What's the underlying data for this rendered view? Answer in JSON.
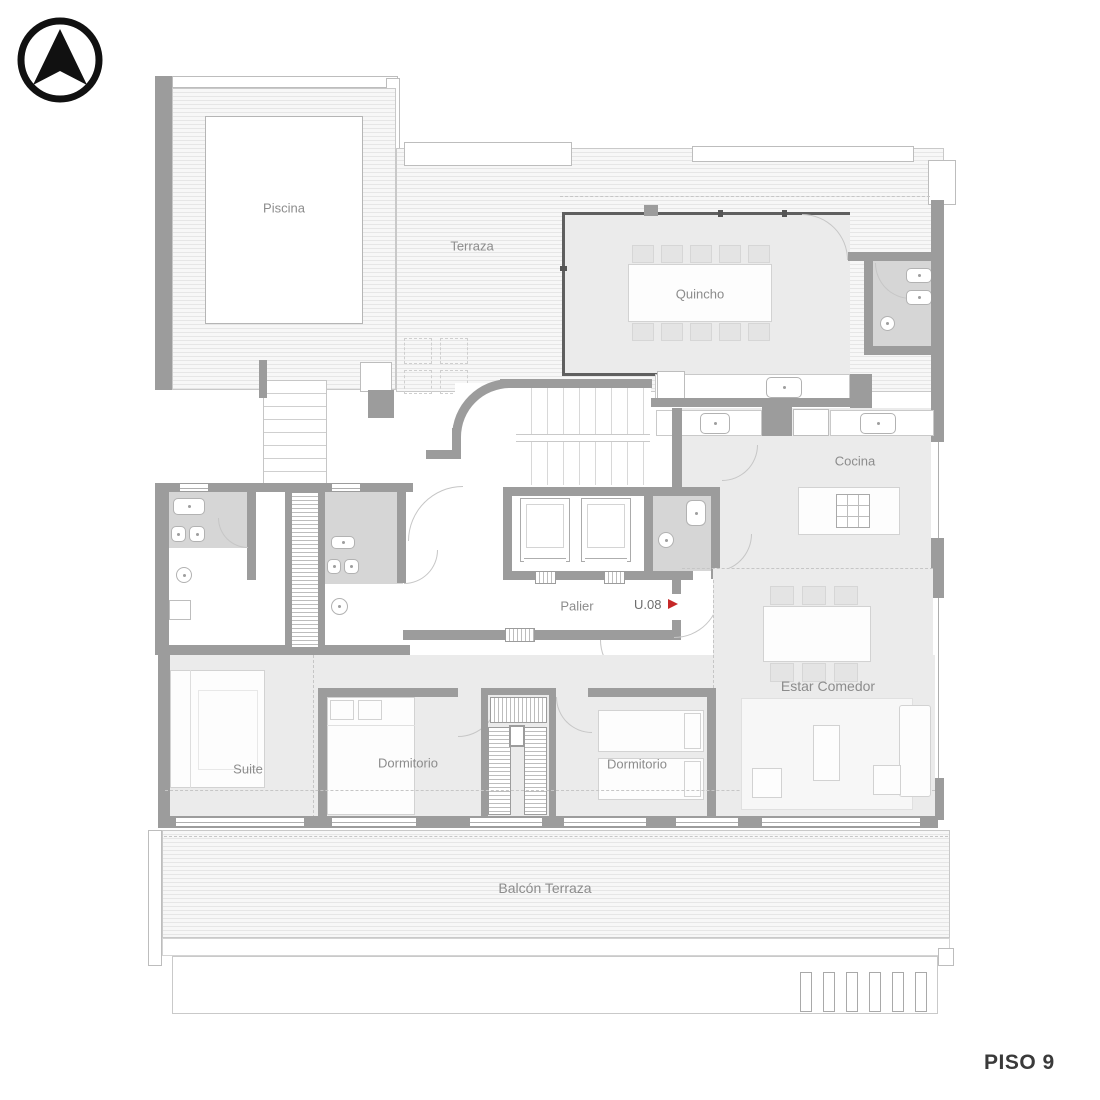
{
  "plan": {
    "floor_label": "PISO 9",
    "unit": {
      "label": "U.08",
      "arrow": "▶"
    },
    "rooms": {
      "piscina": "Piscina",
      "terraza": "Terraza",
      "quincho": "Quincho",
      "cocina": "Cocina",
      "palier": "Palier",
      "estar_comedor": "Estar Comedor",
      "suite": "Suite",
      "dormitorio_1": "Dormitorio",
      "dormitorio_2": "Dormitorio",
      "balcon_terraza": "Balcón Terraza"
    },
    "icons": {
      "north_arrow": "north-arrow-icon",
      "unit_direction": "red-right-arrow"
    },
    "colors": {
      "wall": "#9c9c9c",
      "room_fill": "#ebebeb",
      "bath_fill": "#d6d6d6",
      "deck_stripe": "#e6e6e6",
      "label_text": "#8c8c8c",
      "accent_red": "#c62828",
      "floor_text": "#3a3a3a"
    }
  }
}
